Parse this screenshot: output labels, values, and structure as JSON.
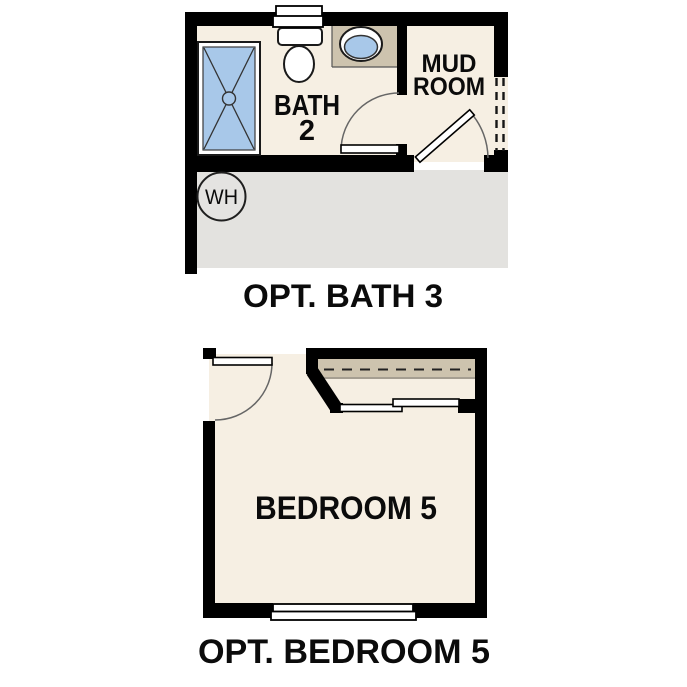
{
  "colors": {
    "wall": "#000000",
    "floor_cream": "#F6EFE3",
    "counter_tan": "#CDC3AE",
    "fixture_blue": "#A8C8E9",
    "garage_gray": "#E3E2DF",
    "water_heater_gray": "#E4E3E1",
    "text": "#0B0B0B"
  },
  "bath_plan": {
    "labels": {
      "bath_line1": "BATH",
      "bath_line2": "2",
      "mud_line1": "MUD",
      "mud_line2": "ROOM",
      "water_heater": "WH"
    },
    "caption": "OPT. BATH 3"
  },
  "bedroom_plan": {
    "labels": {
      "room": "BEDROOM 5"
    },
    "caption": "OPT. BEDROOM 5"
  },
  "symbols": {
    "shower": "shower-pan-with-x-and-drain",
    "toilet": "toilet-top-view",
    "sink": "oval-basin-in-counter",
    "water_heater": "circle-with-WH",
    "door": "quarter-arc-swing",
    "window": "double-rect-window",
    "closet_shelf": "dashed-shelf-line",
    "pass_through": "double-dashed-opening"
  }
}
